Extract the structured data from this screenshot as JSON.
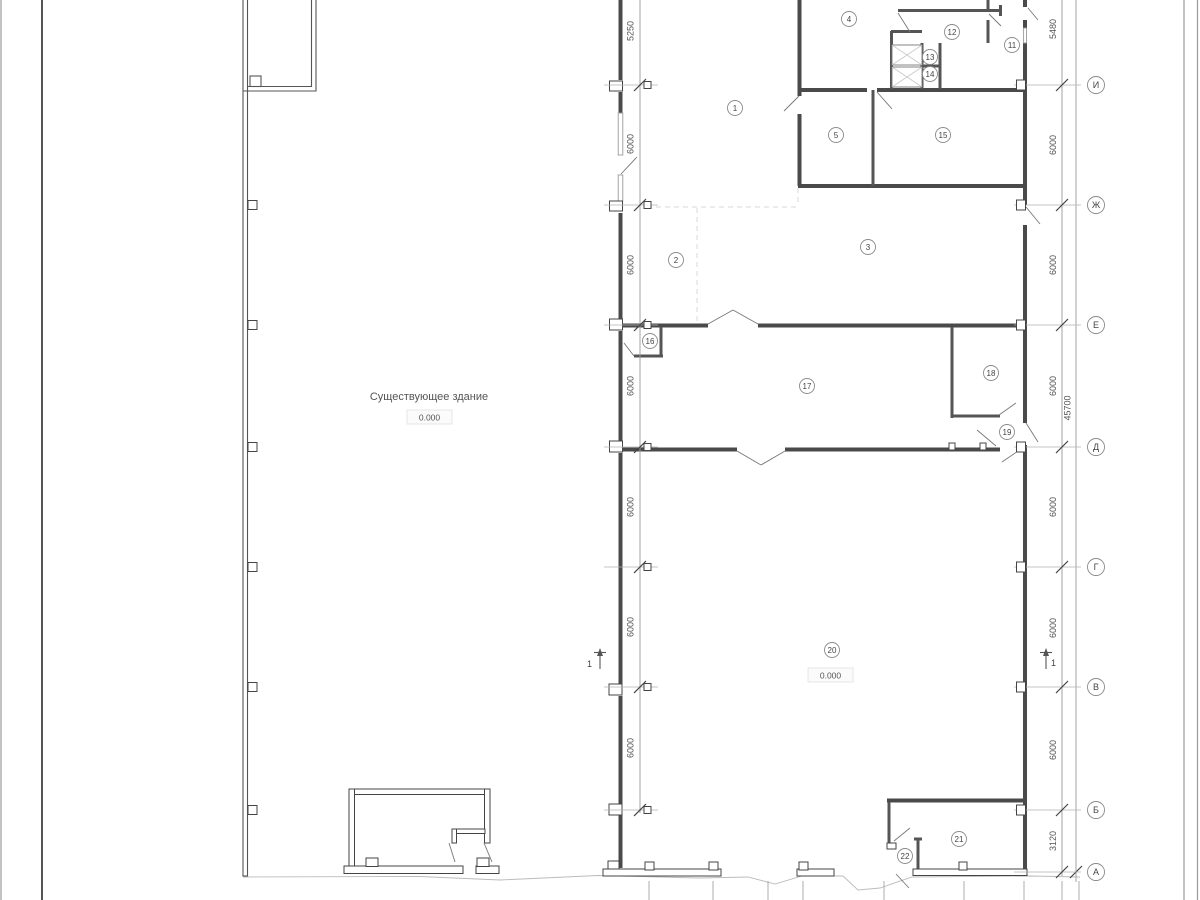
{
  "labels": {
    "existing_building": "Существующее здание",
    "existing_elevation": "0.000",
    "new_elevation": "0.000"
  },
  "axes": [
    {
      "label": "И",
      "y": 85
    },
    {
      "label": "Ж",
      "y": 205
    },
    {
      "label": "Е",
      "y": 325
    },
    {
      "label": "Д",
      "y": 447
    },
    {
      "label": "Г",
      "y": 567
    },
    {
      "label": "В",
      "y": 687
    },
    {
      "label": "Б",
      "y": 810
    },
    {
      "label": "А",
      "y": 872
    }
  ],
  "dim_left": {
    "line_x": 640,
    "labels": [
      {
        "text": "5250",
        "y": 31
      },
      {
        "text": "6000",
        "y": 144
      },
      {
        "text": "6000",
        "y": 265
      },
      {
        "text": "6000",
        "y": 386
      },
      {
        "text": "6000",
        "y": 507
      },
      {
        "text": "6000",
        "y": 627
      },
      {
        "text": "6000",
        "y": 748
      }
    ]
  },
  "dim_right": {
    "line_x": 1062,
    "labels": [
      {
        "text": "5480",
        "y": 29
      },
      {
        "text": "6000",
        "y": 145
      },
      {
        "text": "6000",
        "y": 265
      },
      {
        "text": "6000",
        "y": 386
      },
      {
        "text": "6000",
        "y": 507
      },
      {
        "text": "6000",
        "y": 628
      },
      {
        "text": "6000",
        "y": 750
      },
      {
        "text": "3120",
        "y": 841
      }
    ],
    "total": {
      "text": "45700",
      "x": 1070.5,
      "y": 408
    }
  },
  "rooms": [
    {
      "n": "1",
      "x": 735,
      "y": 108
    },
    {
      "n": "2",
      "x": 676,
      "y": 260
    },
    {
      "n": "3",
      "x": 868,
      "y": 247
    },
    {
      "n": "4",
      "x": 849,
      "y": 19
    },
    {
      "n": "5",
      "x": 836,
      "y": 135
    },
    {
      "n": "11",
      "x": 1012,
      "y": 45
    },
    {
      "n": "12",
      "x": 952,
      "y": 32
    },
    {
      "n": "13",
      "x": 930,
      "y": 57
    },
    {
      "n": "14",
      "x": 930,
      "y": 74
    },
    {
      "n": "15",
      "x": 943,
      "y": 135
    },
    {
      "n": "16",
      "x": 650,
      "y": 341
    },
    {
      "n": "17",
      "x": 807,
      "y": 386
    },
    {
      "n": "18",
      "x": 991,
      "y": 373
    },
    {
      "n": "19",
      "x": 1007,
      "y": 432
    },
    {
      "n": "20",
      "x": 832,
      "y": 650
    },
    {
      "n": "21",
      "x": 959,
      "y": 839
    },
    {
      "n": "22",
      "x": 905,
      "y": 856
    }
  ],
  "section_marks": [
    {
      "label": "1"
    },
    {
      "label": "1"
    }
  ]
}
